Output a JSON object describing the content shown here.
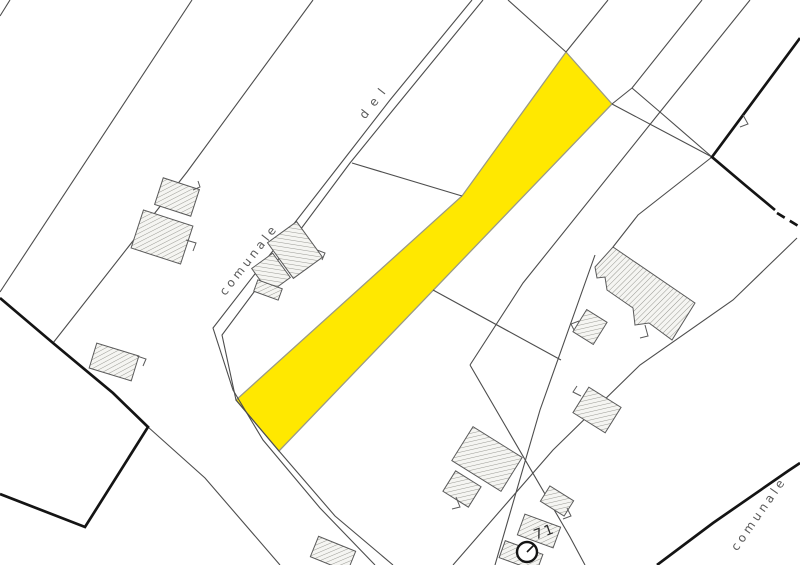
{
  "map": {
    "title": "cadastral-parcel-map",
    "labels": {
      "road_upper": "comunale",
      "road_upper_continuation": "del",
      "road_lower_right": "comunale",
      "parcel_number": "71"
    },
    "colors": {
      "highlight_fill": "#ffe800",
      "highlight_stroke": "#9a9a85",
      "parcel_line": "#4d4d4d",
      "municipal_boundary": "#141414",
      "building_stroke": "#5a5a5a",
      "background": "#ffffff"
    },
    "symbols": {
      "well_circle": "circle-marker-icon"
    }
  }
}
